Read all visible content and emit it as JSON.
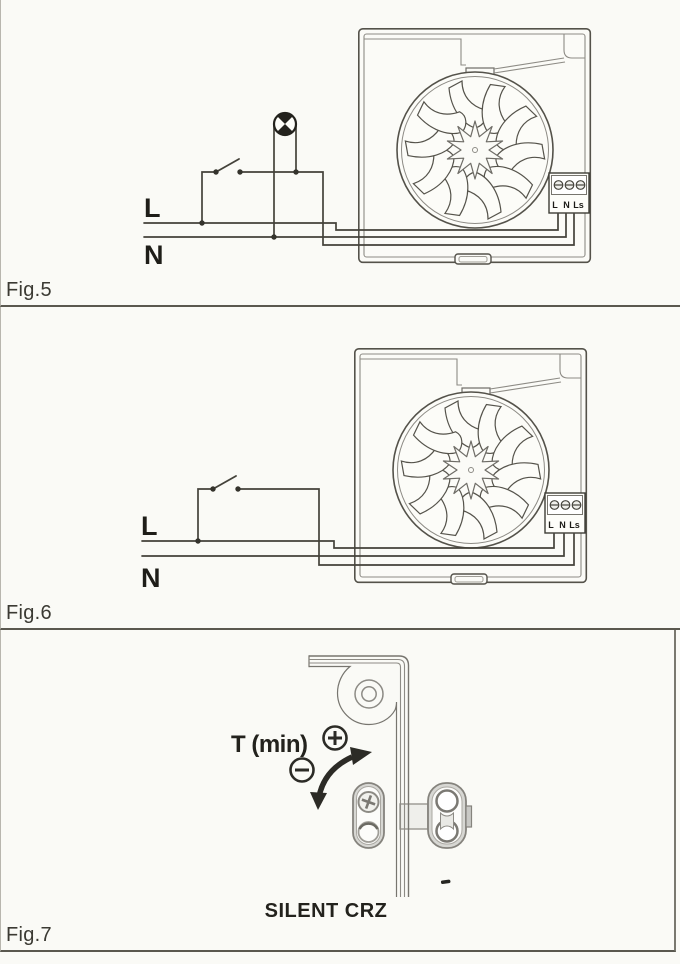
{
  "document": {
    "kind": "scanned wiring-diagram manual page",
    "product": "SILENT CRZ"
  },
  "colors": {
    "paper": "#fafaf6",
    "circuit_line": "#44423a",
    "housing_line": "#8d8b85",
    "panel_border": "#5a584f"
  },
  "fan_unit": {
    "terminals": [
      "L",
      "N",
      "Ls"
    ]
  },
  "figures": [
    {
      "caption": "Fig.5",
      "live_label": "L",
      "neutral_label": "N",
      "symbols": [
        "lamp",
        "single-pole switch",
        "fan unit with L N Ls terminal block"
      ]
    },
    {
      "caption": "Fig.6",
      "live_label": "L",
      "neutral_label": "N",
      "symbols": [
        "single-pole switch",
        "fan unit with L N Ls terminal block"
      ]
    },
    {
      "caption": "Fig.7",
      "adjustment_label": "T (min)",
      "plus_symbol": "+",
      "minus_symbol": "−",
      "product_label": "SILENT CRZ",
      "symbols": [
        "timer potentiometer screw",
        "rotation arrow",
        "housing corner with screw boss"
      ]
    }
  ]
}
